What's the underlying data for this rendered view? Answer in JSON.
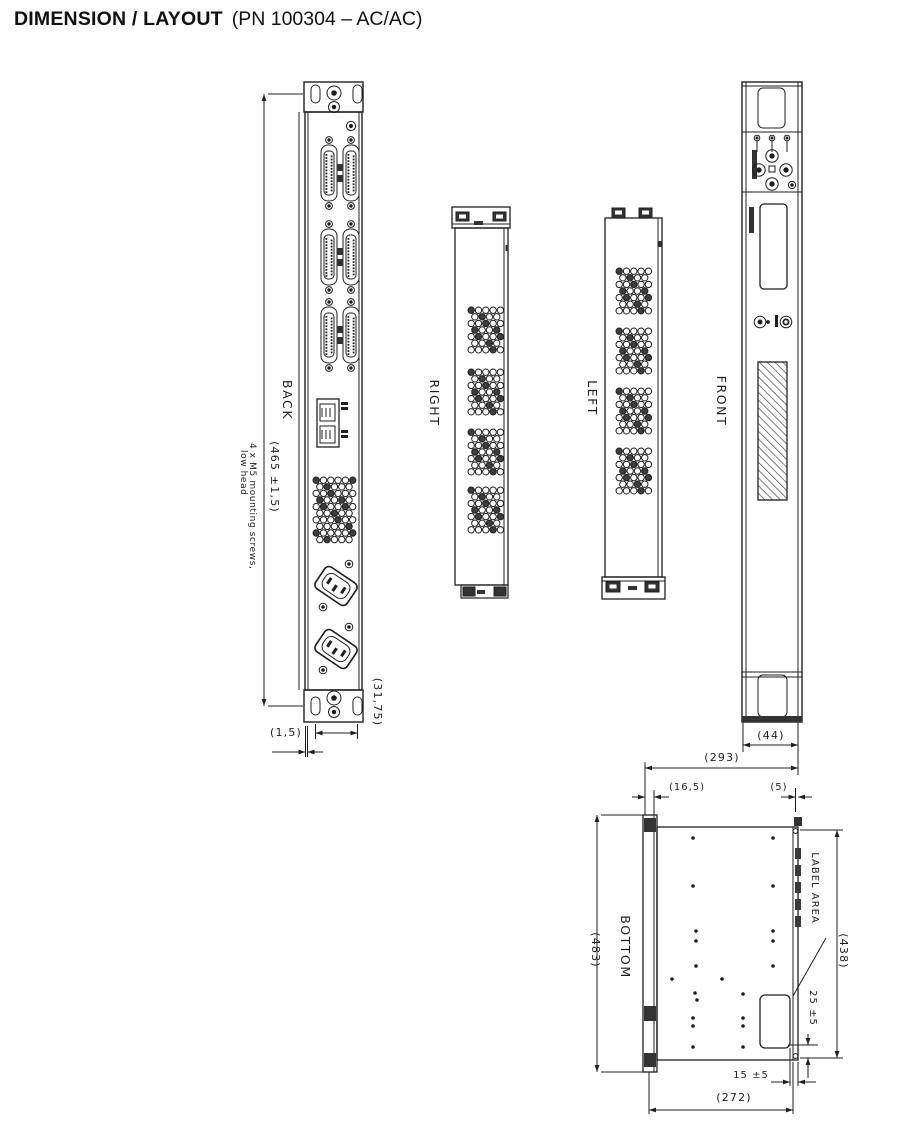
{
  "title": {
    "main": "DIMENSION / LAYOUT",
    "part_number": "(PN 100304 – AC/AC)"
  },
  "views": {
    "back": "BACK",
    "right": "RIGHT",
    "left": "LEFT",
    "front": "FRONT",
    "bottom": "BOTTOM"
  },
  "annotations": {
    "mounting_note_line1": "4 x M5 mounting screws,",
    "mounting_note_line2": "low head",
    "label_area": "LABEL AREA"
  },
  "dimensions": {
    "back_height": "(465 ±1,5)",
    "back_panel_offset": "(1,5)",
    "back_hole_pitch": "(31,75)",
    "front_width": "(44)",
    "depth_overall": "(293)",
    "inset_left": "(16,5)",
    "inset_right": "(5)",
    "panel_width": "(483)",
    "body_width": "(438)",
    "label_area_offset_bottom": "25 ±5",
    "label_area_offset_right": "15 ±5",
    "body_depth": "(272)"
  }
}
